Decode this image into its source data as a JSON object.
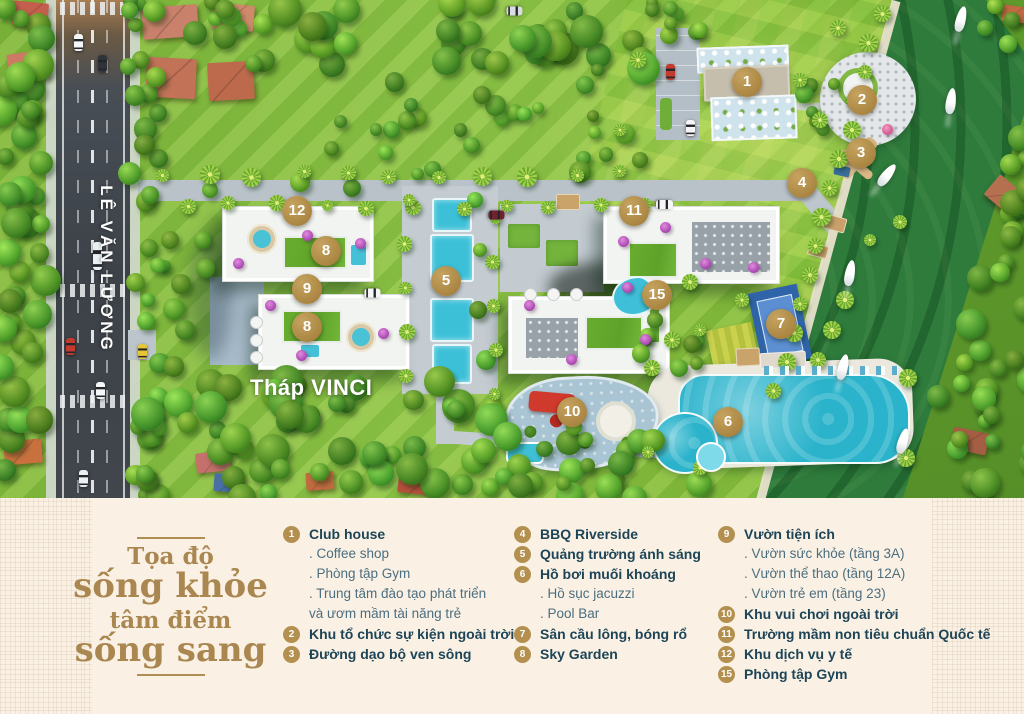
{
  "map": {
    "street_label": "LÊ VĂN LƯƠNG",
    "tower_label": "Tháp VINCI",
    "markers": [
      "1",
      "2",
      "3",
      "4",
      "5",
      "6",
      "7",
      "8",
      "8",
      "9",
      "10",
      "11",
      "12",
      "15"
    ]
  },
  "footer": {
    "title": {
      "line1": "Tọa độ",
      "line2": "sống khỏe",
      "line3": "tâm điểm",
      "line4": "sống sang"
    },
    "columns": [
      {
        "items": [
          {
            "num": "1",
            "label": "Club house",
            "subs": [
              ". Coffee shop",
              ". Phòng tập Gym",
              ". Trung tâm đào tạo phát triển",
              "và ươm mầm tài năng trẻ"
            ]
          },
          {
            "num": "2",
            "label": "Khu tổ chức sự kiện ngoài trời",
            "subs": []
          },
          {
            "num": "3",
            "label": "Đường dạo bộ ven sông",
            "subs": []
          }
        ]
      },
      {
        "items": [
          {
            "num": "4",
            "label": "BBQ Riverside",
            "subs": []
          },
          {
            "num": "5",
            "label": "Quảng trường ánh sáng",
            "subs": []
          },
          {
            "num": "6",
            "label": "Hồ bơi muối khoáng",
            "subs": [
              ". Hồ sục jacuzzi",
              ". Pool Bar"
            ]
          },
          {
            "num": "7",
            "label": "Sân cầu lông, bóng rổ",
            "subs": []
          },
          {
            "num": "8",
            "label": "Sky Garden",
            "subs": []
          }
        ]
      },
      {
        "items": [
          {
            "num": "9",
            "label": "Vườn tiện ích",
            "subs": [
              ". Vườn sức khỏe (tầng 3A)",
              ". Vườn thể thao (tầng 12A)",
              ". Vườn trẻ em (tầng 23)"
            ]
          },
          {
            "num": "10",
            "label": "Khu vui chơi ngoài trời",
            "subs": []
          },
          {
            "num": "11",
            "label": "Trường mầm non tiêu chuẩn Quốc tế",
            "subs": []
          },
          {
            "num": "12",
            "label": "Khu dịch vụ y tế",
            "subs": []
          },
          {
            "num": "15",
            "label": "Phòng tập Gym",
            "subs": []
          }
        ]
      }
    ]
  },
  "colors": {
    "accent_gold": "#b3904f",
    "title_gold": "#aa8750",
    "text_navy": "#1d4557",
    "footer_bg": "#faf1e4",
    "lawn_green": "#8ec446",
    "river_green": "#2e7b3c",
    "pool_blue": "#2ab3cb",
    "road_gray": "#3c4248"
  }
}
